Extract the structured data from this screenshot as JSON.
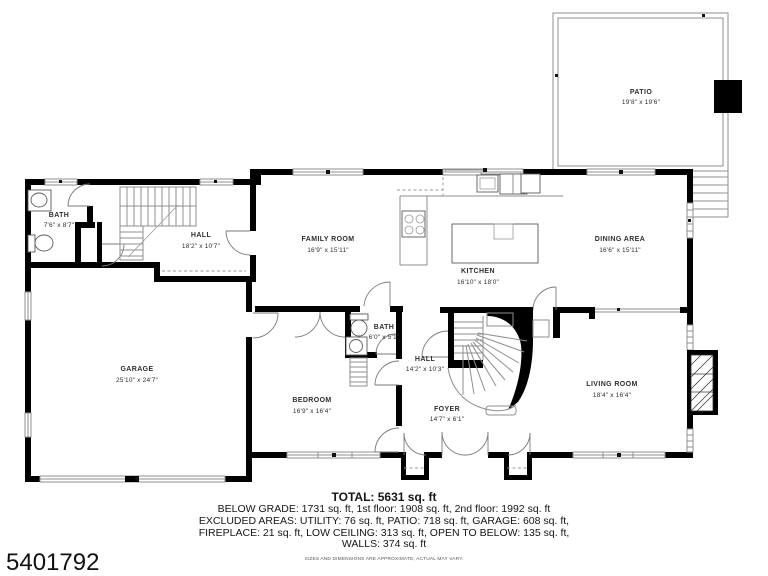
{
  "plan": {
    "colors": {
      "wall": "#000000",
      "line": "#8f8f8f",
      "label": "#2e2e2e"
    },
    "rooms": [
      {
        "id": "patio",
        "name": "PATIO",
        "dims": "19'8\" x 19'6\""
      },
      {
        "id": "bath-upper",
        "name": "BATH",
        "dims": "7'6\" x 8'7\""
      },
      {
        "id": "hall-upper",
        "name": "HALL",
        "dims": "18'2\" x 10'7\""
      },
      {
        "id": "family-room",
        "name": "FAMILY ROOM",
        "dims": "16'9\" x 15'11\""
      },
      {
        "id": "kitchen",
        "name": "KITCHEN",
        "dims": "16'10\" x 18'0\""
      },
      {
        "id": "dining-area",
        "name": "DINING AREA",
        "dims": "16'6\" x 15'11\""
      },
      {
        "id": "garage",
        "name": "GARAGE",
        "dims": "25'10\" x 24'7\""
      },
      {
        "id": "bedroom",
        "name": "BEDROOM",
        "dims": "16'9\" x 16'4\""
      },
      {
        "id": "bath-lower",
        "name": "BATH",
        "dims": "6'0\" x 5'1\""
      },
      {
        "id": "hall-lower",
        "name": "HALL",
        "dims": "14'2\" x 10'3\""
      },
      {
        "id": "foyer",
        "name": "FOYER",
        "dims": "14'7\" x 6'1\""
      },
      {
        "id": "living-room",
        "name": "LIVING ROOM",
        "dims": "18'4\" x 16'4\""
      }
    ]
  },
  "footer": {
    "total": "TOTAL: 5631 sq. ft",
    "lines": [
      "BELOW GRADE: 1731 sq. ft, 1st floor: 1908 sq. ft, 2nd floor: 1992 sq. ft",
      "EXCLUDED AREAS: UTILITY: 76 sq. ft, PATIO: 718 sq. ft, GARAGE: 608 sq. ft,",
      "FIREPLACE: 21 sq. ft, LOW CEILING: 313 sq. ft, OPEN TO BELOW: 135 sq. ft,",
      "WALLS: 374 sq. ft"
    ],
    "disclaimer": "SIZES AND DIMENSIONS ARE APPROXIMATE, ACTUAL MAY VARY."
  },
  "listing_id": "5401792"
}
